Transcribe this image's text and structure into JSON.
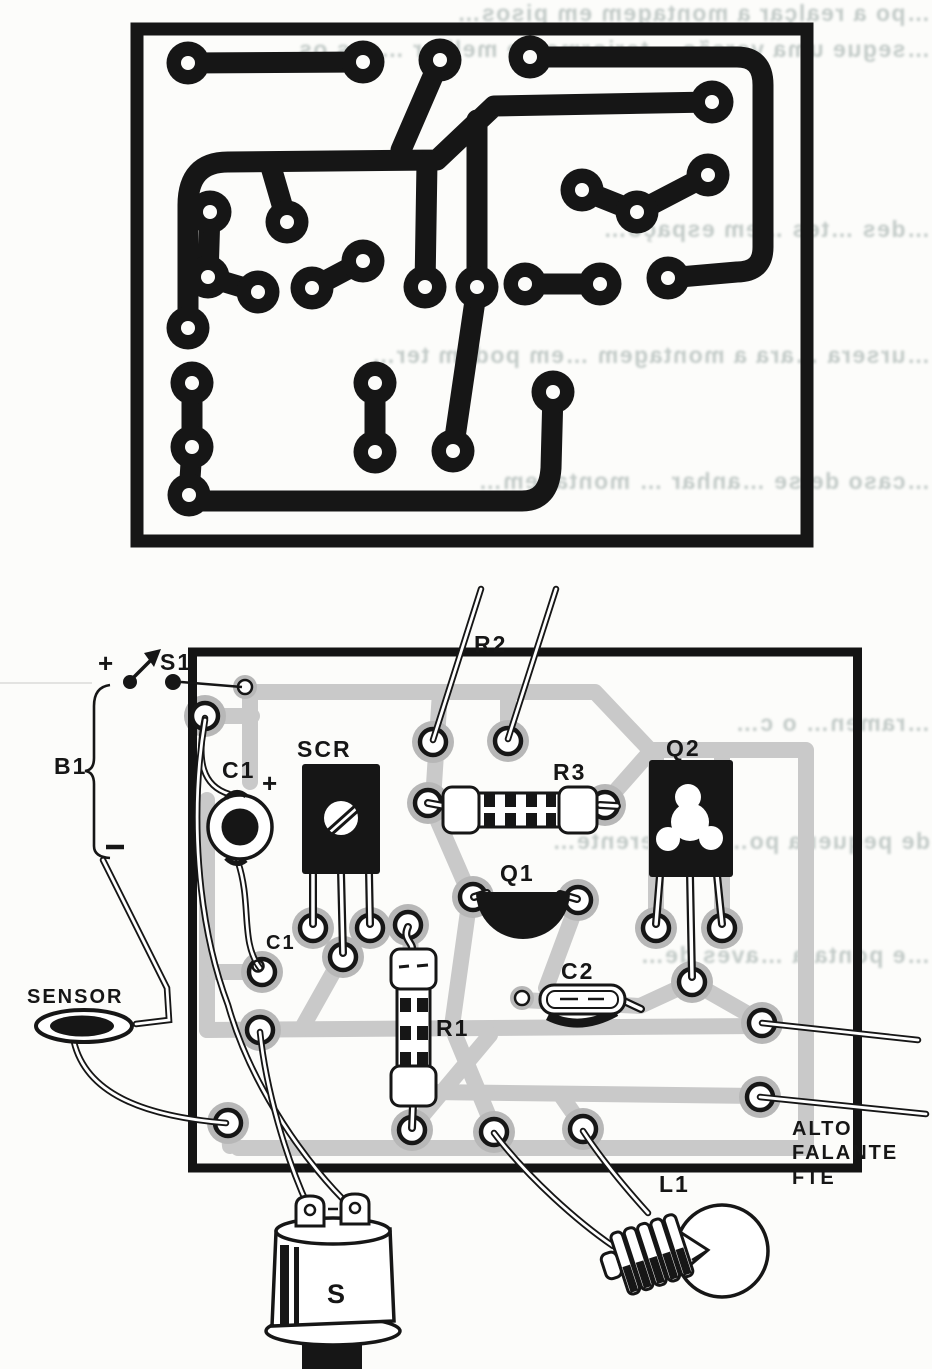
{
  "labels": {
    "s1": "S1",
    "b1": "B1",
    "plus_battery": "+",
    "minus_battery": "−",
    "c1": "C1",
    "c1_plus": "+",
    "c1_board": "C1",
    "scr": "SCR",
    "r2": "R2",
    "r3": "R3",
    "q2": "Q2",
    "q1": "Q1",
    "c2": "C2",
    "r1": "R1",
    "sensor": "SENSOR",
    "alto": "ALTO",
    "falante": "FALANTE",
    "fte": "FTE",
    "l1": "L1",
    "s_siren": "S"
  },
  "bleed": [
    "…po a realçar a montagem em pisos…",
    "…segue uma versão …teriormente melhor …ens os…",
    "…des …tes …em espaço…",
    "…ursera …ara a montagem …em podem ter…",
    "…caso de se …anhar … montagem…",
    "…ramen… o c…",
    "de pequena po…ola …erente…",
    "…e ponta a …aves de…"
  ],
  "colors": {
    "ink": "#161616",
    "copper_trace_gray": "#c9c9c9",
    "pad_halo_gray": "#b7b7b7",
    "bleed_text_gray": "#b4bebb",
    "paper": "#fcfcfa"
  }
}
